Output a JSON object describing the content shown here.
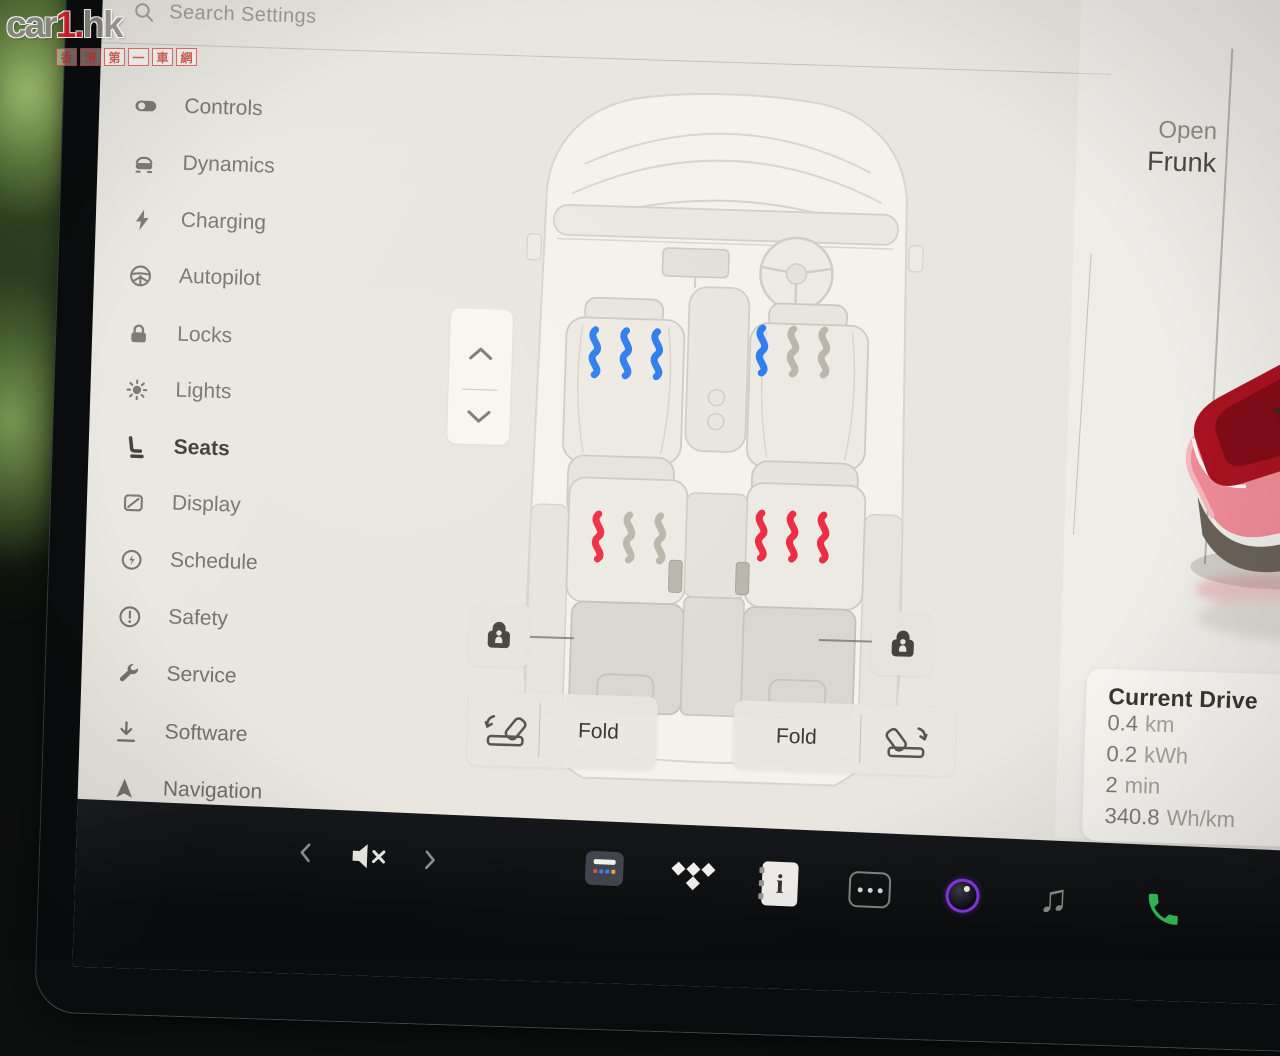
{
  "watermark": {
    "brand_prefix": "car",
    "brand_accent": "1.",
    "brand_suffix": "hk",
    "tagline": [
      "香",
      "港",
      "第",
      "一",
      "車",
      "網"
    ]
  },
  "search": {
    "label": "Search Settings"
  },
  "sidebar": {
    "items": [
      {
        "label": "Controls",
        "icon": "toggle-icon",
        "selected": false
      },
      {
        "label": "Dynamics",
        "icon": "car-icon",
        "selected": false
      },
      {
        "label": "Charging",
        "icon": "bolt-icon",
        "selected": false
      },
      {
        "label": "Autopilot",
        "icon": "steering-wheel-icon",
        "selected": false
      },
      {
        "label": "Locks",
        "icon": "padlock-icon",
        "selected": false
      },
      {
        "label": "Lights",
        "icon": "sun-icon",
        "selected": false
      },
      {
        "label": "Seats",
        "icon": "seat-icon",
        "selected": true
      },
      {
        "label": "Display",
        "icon": "display-icon",
        "selected": false
      },
      {
        "label": "Schedule",
        "icon": "clock-icon",
        "selected": false
      },
      {
        "label": "Safety",
        "icon": "alert-circle-icon",
        "selected": false
      },
      {
        "label": "Service",
        "icon": "wrench-icon",
        "selected": false
      },
      {
        "label": "Software",
        "icon": "download-icon",
        "selected": false
      },
      {
        "label": "Navigation",
        "icon": "navigation-arrow-icon",
        "selected": false
      }
    ]
  },
  "seat_panel": {
    "seats": [
      {
        "id": "front-left",
        "mode": "cool",
        "level": 3,
        "waves": [
          "#2b7bee",
          "#2b7bee",
          "#2b7bee"
        ]
      },
      {
        "id": "front-right",
        "mode": "cool",
        "level": 1,
        "waves": [
          "#2b7bee",
          "#b9b6ac",
          "#b9b6ac"
        ]
      },
      {
        "id": "rear-left",
        "mode": "heat",
        "level": 1,
        "waves": [
          "#ee2b44",
          "#b9b6ac",
          "#b9b6ac"
        ]
      },
      {
        "id": "rear-right",
        "mode": "heat",
        "level": 3,
        "waves": [
          "#ee2b44",
          "#ee2b44",
          "#ee2b44"
        ]
      }
    ],
    "fold_left_label": "Fold",
    "fold_right_label": "Fold"
  },
  "right_panel": {
    "open_frunk_line1": "Open",
    "open_frunk_line2": "Frunk",
    "current_drive": {
      "title": "Current Drive",
      "stats": [
        {
          "value": "0.4",
          "unit": "km"
        },
        {
          "value": "0.2",
          "unit": "kWh"
        },
        {
          "value": "2",
          "unit": "min"
        },
        {
          "value": "340.8",
          "unit": "Wh/km"
        }
      ]
    }
  },
  "dock": {
    "icons": [
      "previous",
      "volume-muted",
      "next",
      "app-launcher",
      "tidal",
      "owners-manual",
      "more-apps",
      "camera",
      "music",
      "phone"
    ]
  },
  "colors": {
    "cool_wave": "#2b7bee",
    "heat_wave": "#ee2b44",
    "inactive_wave": "#b9b6ac",
    "phone_green": "#35c75a",
    "brand_red": "#d6202c"
  }
}
